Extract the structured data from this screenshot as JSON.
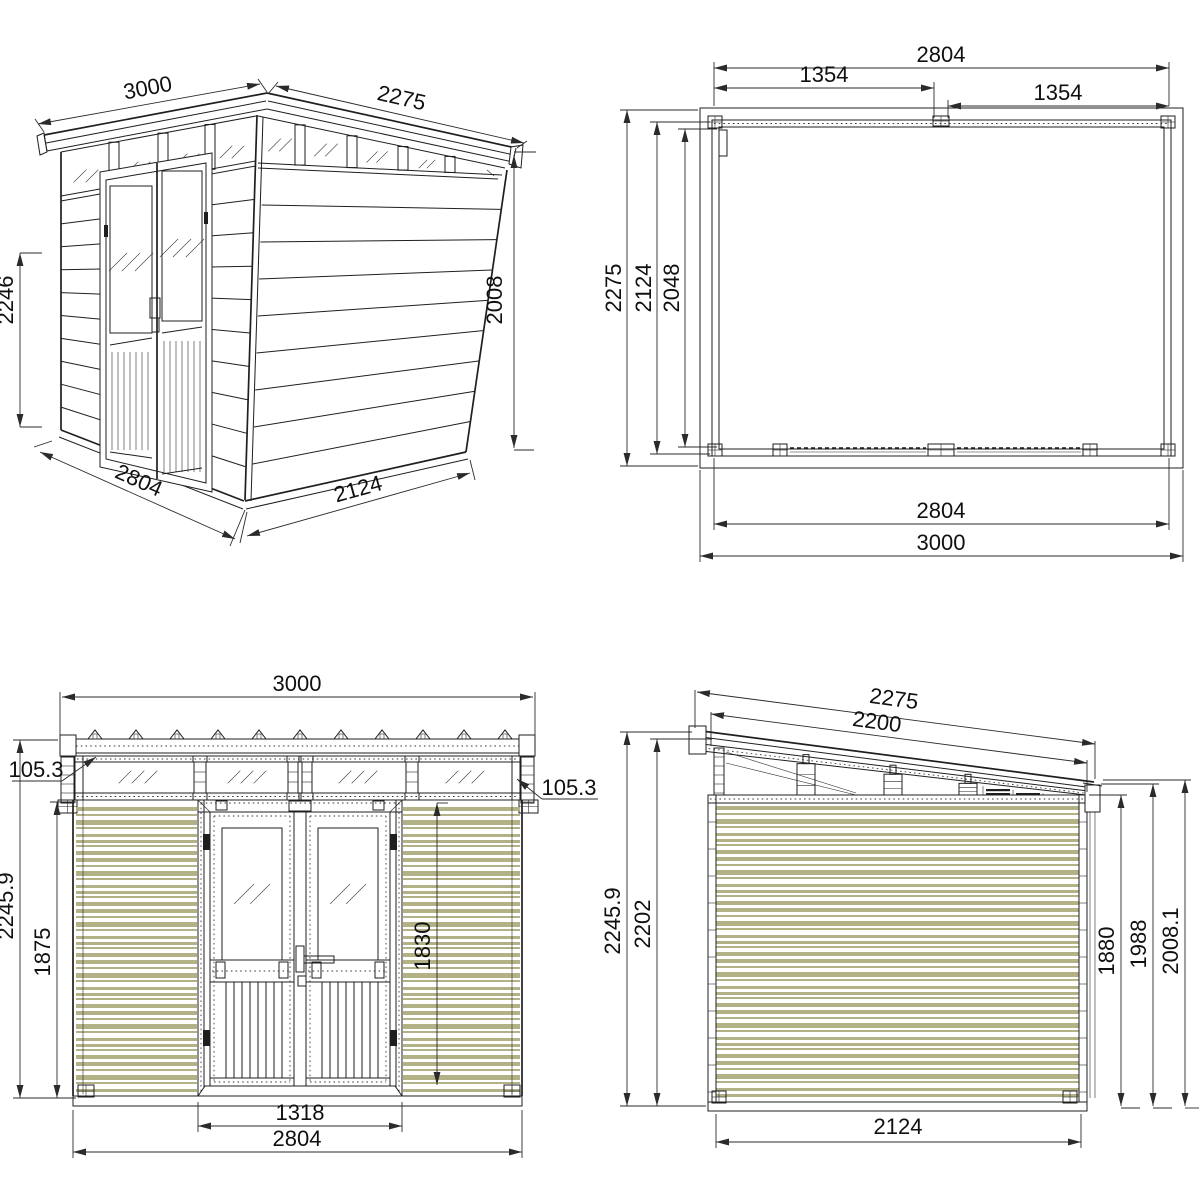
{
  "sheet": {
    "background": "#ffffff",
    "line_color": "#1f1f1f",
    "dim_color": "#2b2b2b",
    "siding_color": "#b3b287",
    "description": "Pent-roof garden shed technical drawing, four dimensioned views"
  },
  "views": {
    "perspective": {
      "title": "perspective-view",
      "dims": {
        "roof_width": "3000",
        "roof_depth": "2275",
        "front_height": "2246",
        "rear_height": "2008",
        "base_width": "2804",
        "base_depth": "2124"
      }
    },
    "plan": {
      "title": "roof-plan-view",
      "dims": {
        "wall_width_top": "2804",
        "bay_left": "1354",
        "bay_right": "1354",
        "roof_depth": "2275",
        "wall_depth": "2124",
        "interior_depth": "2048",
        "wall_width_bottom": "2804",
        "roof_width": "3000"
      }
    },
    "front_elevation": {
      "title": "front-elevation-view",
      "dims": {
        "roof_width": "3000",
        "overhang_left": "105.3",
        "overhang_right": "105.3",
        "overall_height": "2245.9",
        "wall_height": "1875",
        "door_height": "1830",
        "door_width": "1318",
        "wall_width": "2804"
      }
    },
    "side_elevation": {
      "title": "side-elevation-view",
      "dims": {
        "roof_length": "2275",
        "roof_clear_length": "2200",
        "overall_height": "2245.9",
        "front_post_height": "2202",
        "rear_wall_height": "1880",
        "rear_height": "1988",
        "rear_overall_height": "2008.1",
        "base_depth": "2124"
      }
    }
  }
}
